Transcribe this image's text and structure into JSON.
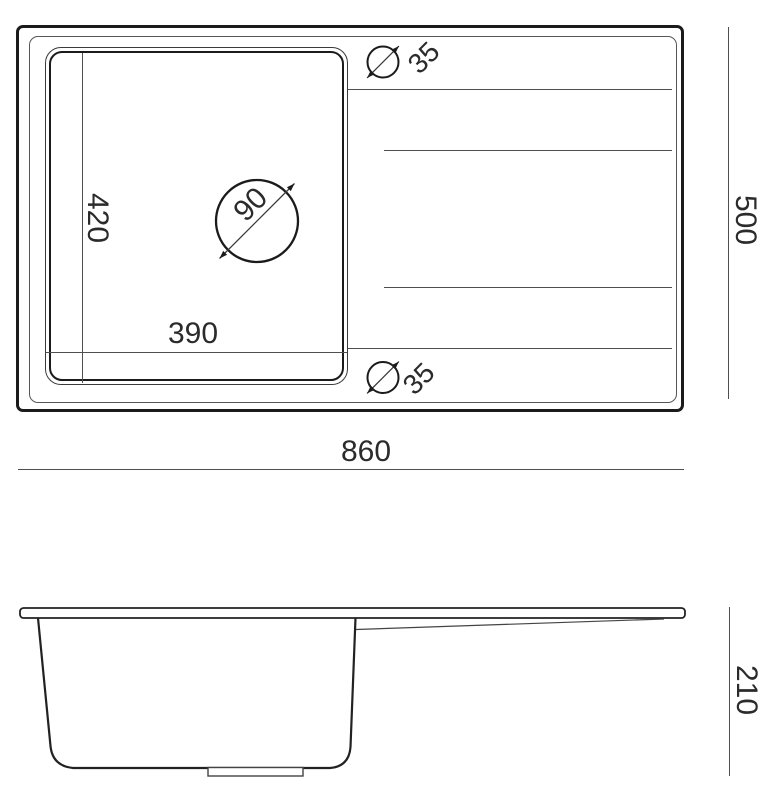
{
  "drawing": {
    "top_view": {
      "overall_width_label": "860",
      "overall_depth_label": "500",
      "bowl_width_label": "390",
      "bowl_depth_label": "420",
      "drain_diameter_label": "90",
      "top_hole_diameter_label": "35",
      "bottom_hole_diameter_label": "35"
    },
    "side_view": {
      "height_label": "210"
    }
  },
  "colors": {
    "outline": "#1b1b1b",
    "thin_line": "#4f4f4f",
    "text": "#2b2b2b",
    "background": "#ffffff"
  }
}
